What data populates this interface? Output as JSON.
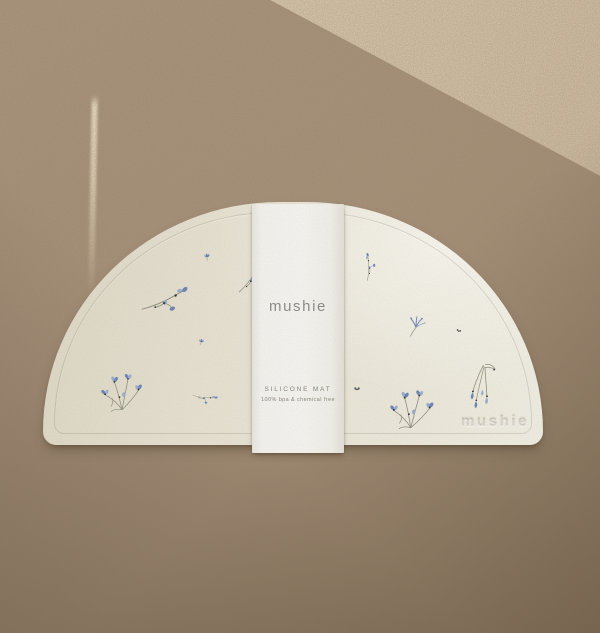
{
  "product_photo": {
    "sleeve": {
      "logo": "mushie",
      "label_title": "SILICONE MAT",
      "label_subtitle": "100% bpa & chemical free"
    },
    "mat": {
      "embossed_logo": "mushie",
      "shape": "half-moon silicone placemat",
      "pattern": "scattered blue wildflowers"
    },
    "palette": {
      "background_tan": "#ab957d",
      "background_shadow": "#8d785f",
      "sunlight_beige": "#d8c5aa",
      "mat_ivory": "#eae6d8",
      "sleeve_white": "#f5f4f0",
      "logo_gray": "#8d8c88",
      "flower_blue": "#6d86b2",
      "flower_blue_light": "#9aadcd",
      "flower_navy": "#31353f",
      "stem_gray": "#8f8f7d"
    },
    "flowers": [
      {
        "kind": "bud",
        "x": 207,
        "y": 257,
        "scale": 0.5,
        "rotate": -8
      },
      {
        "kind": "sprig",
        "x": 249,
        "y": 278,
        "scale": 0.7,
        "rotate": -18
      },
      {
        "kind": "sprig",
        "x": 164,
        "y": 298,
        "scale": 1.0,
        "rotate": 10
      },
      {
        "kind": "bud",
        "x": 201,
        "y": 342,
        "scale": 0.45,
        "rotate": 12
      },
      {
        "kind": "cluster",
        "x": 122,
        "y": 392,
        "scale": 0.85,
        "rotate": 0
      },
      {
        "kind": "sprig",
        "x": 205,
        "y": 396,
        "scale": 0.5,
        "rotate": 40
      },
      {
        "kind": "sprig",
        "x": 367,
        "y": 267,
        "scale": 0.55,
        "rotate": -55
      },
      {
        "kind": "fan",
        "x": 416,
        "y": 326,
        "scale": 0.7,
        "rotate": 0
      },
      {
        "kind": "moth",
        "x": 459,
        "y": 330,
        "scale": 0.5,
        "rotate": 20
      },
      {
        "kind": "moth",
        "x": 357,
        "y": 388,
        "scale": 0.6,
        "rotate": 0
      },
      {
        "kind": "cluster",
        "x": 412,
        "y": 409,
        "scale": 0.9,
        "rotate": 4
      },
      {
        "kind": "bells",
        "x": 481,
        "y": 388,
        "scale": 0.85,
        "rotate": 6
      }
    ]
  }
}
